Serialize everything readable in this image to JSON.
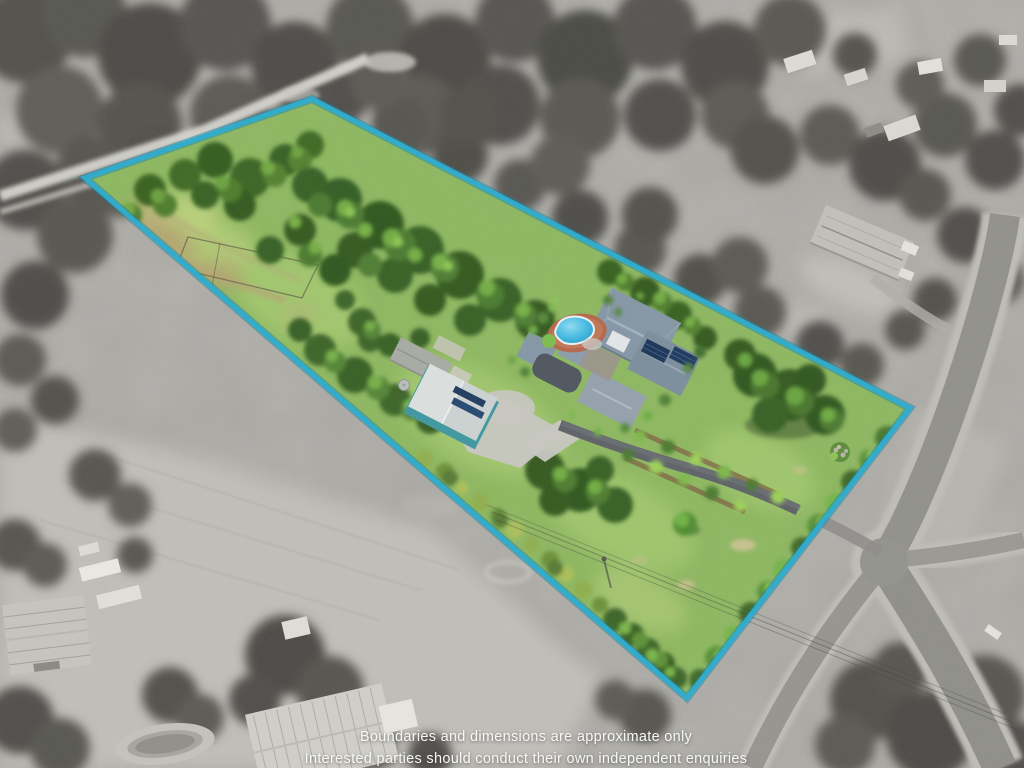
{
  "disclaimer": {
    "line1": "Boundaries and dimensions are approximate only",
    "line2": "Interested parties should conduct their own independent enquiries"
  },
  "colors": {
    "boundary_line": "#29abce",
    "pool_water": "#3fb9e2",
    "solar_panels": "#1b3254",
    "shed_wall_teal": "#3e979e",
    "lot_grass": "#8db95d"
  }
}
